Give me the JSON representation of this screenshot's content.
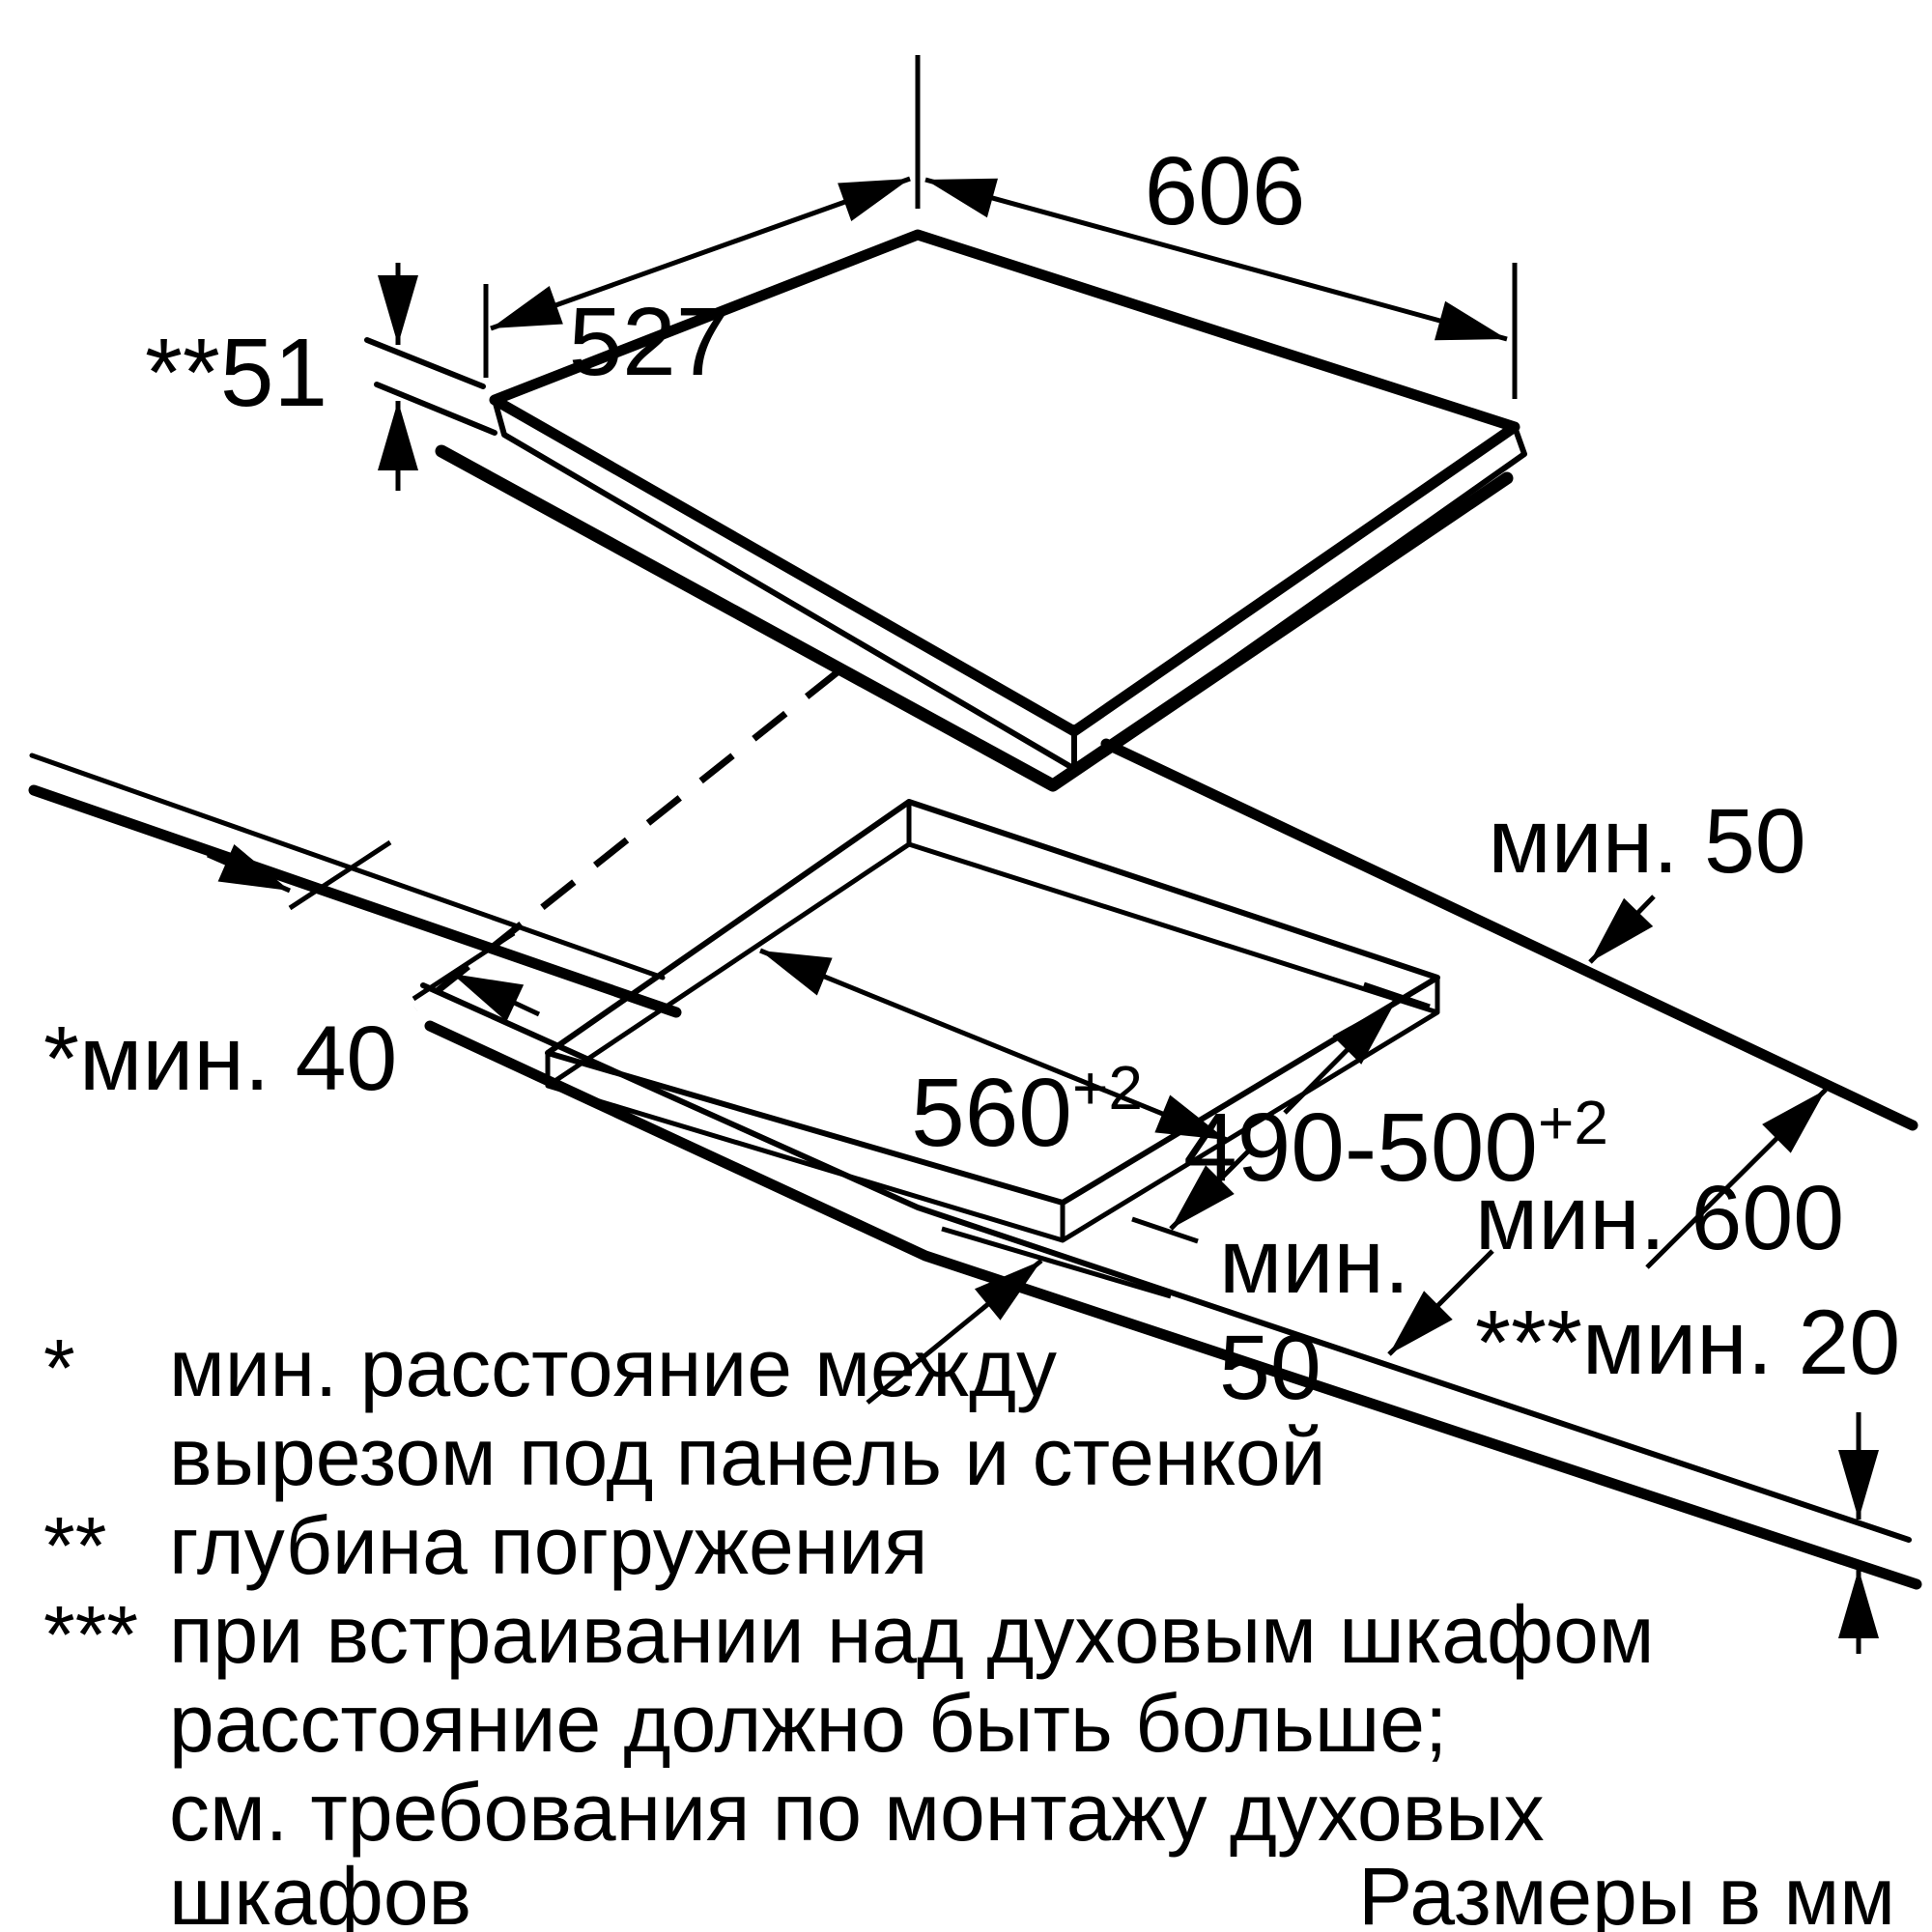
{
  "diagram": {
    "type": "installation-drawing",
    "units_note": "Размеры в мм",
    "colors": {
      "line": "#000000",
      "background": "#ffffff"
    },
    "panel": {
      "width": "606",
      "depth": "527",
      "immersion_depth": "**51"
    },
    "cutout": {
      "width_base": "560",
      "width_sup": "+2",
      "depth_base": "490-500",
      "depth_sup": "+2",
      "min_back_clearance": "мин. 50",
      "min_front_clearance_line1": "мин.",
      "min_front_clearance_line2": "50",
      "min_wall_clearance": "*мин. 40",
      "min_worktop_depth": "мин. 600",
      "min_gap_below": "***мин. 20"
    },
    "footnotes": {
      "f1_marker": "*",
      "f1_line1": "мин. расстояние между",
      "f1_line2": "вырезом под панель и стенкой",
      "f2_marker": "**",
      "f2_line1": "глубина погружения",
      "f3_marker": "***",
      "f3_line1": "при встраивании над духовым шкафом",
      "f3_line2": "расстояние должно быть больше;",
      "f3_line3": "см. требования по монтажу духовых",
      "f3_line4": "шкафов"
    }
  }
}
